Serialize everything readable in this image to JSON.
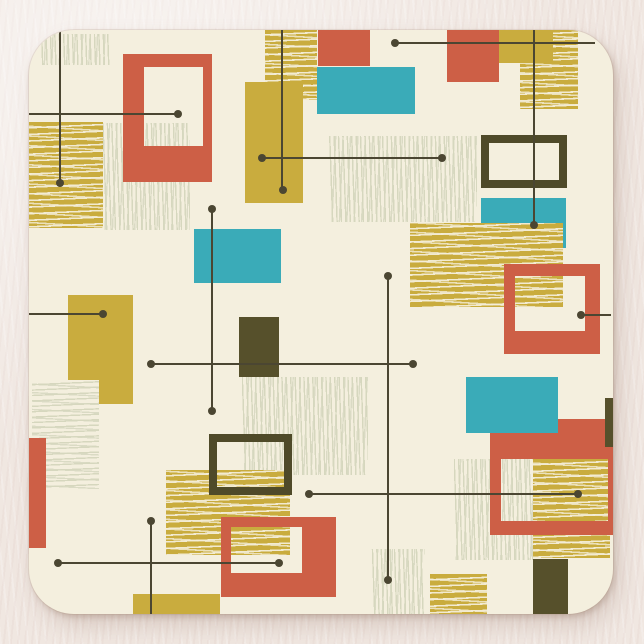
{
  "scene": {
    "description": "Square coaster product photo with mid-century modern abstract geometric pattern",
    "background_color": "#f0e7e1",
    "palette": {
      "cream": "#f4efde",
      "red": "#cd5f46",
      "teal": "#3aabb8",
      "mustard": "#c9ac3e",
      "olive": "#56502b",
      "olive_frame": "#4f4a29",
      "line": "#4b4632",
      "light_hatch_stroke": "#d6d7be",
      "mustard_hatch_stroke": "#f4eed9"
    },
    "coaster": {
      "x": 29,
      "y": 30,
      "w": 584,
      "h": 584,
      "radius": 45,
      "face_color": "#f4efde"
    },
    "shapes": [
      {
        "name": "hatch-light-topleft-corner",
        "type": "hatch",
        "hatch": "light-v",
        "x": 39,
        "y": 34,
        "w": 71,
        "h": 31
      },
      {
        "name": "hatch-mustard-left",
        "type": "hatch",
        "hatch": "mustard-h",
        "x": 29,
        "y": 122,
        "w": 74,
        "h": 106
      },
      {
        "name": "hatch-light-midleft",
        "type": "hatch",
        "hatch": "light-v",
        "x": 103,
        "y": 123,
        "w": 87,
        "h": 107
      },
      {
        "name": "frame-red-topleft",
        "type": "frame",
        "color": "red",
        "x": 123,
        "y": 54,
        "w": 89,
        "h": 128,
        "borders": {
          "t": 13,
          "r": 9,
          "b": 36,
          "l": 21
        }
      },
      {
        "name": "hatch-mustard-topcenter",
        "type": "hatch",
        "hatch": "mustard-h",
        "x": 265,
        "y": 29,
        "w": 52,
        "h": 71
      },
      {
        "name": "rect-mustard-topcenter",
        "type": "rect",
        "color": "mustard",
        "x": 245,
        "y": 82,
        "w": 58,
        "h": 121
      },
      {
        "name": "rect-red-top-a",
        "type": "rect",
        "color": "red",
        "x": 318,
        "y": 28,
        "w": 52,
        "h": 38
      },
      {
        "name": "rect-teal-top",
        "type": "rect",
        "color": "teal",
        "x": 317,
        "y": 67,
        "w": 98,
        "h": 47
      },
      {
        "name": "hatch-mustard-topright",
        "type": "hatch",
        "hatch": "mustard-h",
        "x": 520,
        "y": 29,
        "w": 58,
        "h": 80
      },
      {
        "name": "rect-mustard-topright",
        "type": "rect",
        "color": "mustard",
        "x": 499,
        "y": 29,
        "w": 54,
        "h": 34
      },
      {
        "name": "rect-red-top-b",
        "type": "rect",
        "color": "red",
        "x": 447,
        "y": 29,
        "w": 52,
        "h": 53
      },
      {
        "name": "hatch-light-rightmid",
        "type": "hatch",
        "hatch": "light-v",
        "x": 329,
        "y": 136,
        "w": 148,
        "h": 86
      },
      {
        "name": "frame-olive-right",
        "type": "frame",
        "color": "olive_frame",
        "x": 481,
        "y": 135,
        "w": 86,
        "h": 53,
        "borders": {
          "t": 8,
          "r": 8,
          "b": 8,
          "l": 8
        }
      },
      {
        "name": "rect-teal-right",
        "type": "rect",
        "color": "teal",
        "x": 481,
        "y": 198,
        "w": 85,
        "h": 50
      },
      {
        "name": "hatch-mustard-rightmid",
        "type": "hatch",
        "hatch": "mustard-h",
        "x": 410,
        "y": 223,
        "w": 153,
        "h": 84
      },
      {
        "name": "frame-red-right",
        "type": "frame",
        "color": "red",
        "x": 504,
        "y": 264,
        "w": 96,
        "h": 90,
        "borders": {
          "t": 12,
          "r": 15,
          "b": 23,
          "l": 11
        }
      },
      {
        "name": "rect-teal-midleft",
        "type": "rect",
        "color": "teal",
        "x": 194,
        "y": 229,
        "w": 87,
        "h": 54
      },
      {
        "name": "rect-olive-center",
        "type": "rect",
        "color": "olive",
        "x": 239,
        "y": 317,
        "w": 40,
        "h": 60
      },
      {
        "name": "rect-mustard-left",
        "type": "rect",
        "color": "mustard",
        "x": 68,
        "y": 295,
        "w": 65,
        "h": 109
      },
      {
        "name": "hatch-light-left",
        "type": "hatch",
        "hatch": "light-h",
        "x": 32,
        "y": 380,
        "w": 67,
        "h": 109
      },
      {
        "name": "rect-red-leftedge",
        "type": "rect",
        "color": "red",
        "x": 29,
        "y": 438,
        "w": 17,
        "h": 110
      },
      {
        "name": "hatch-light-center",
        "type": "hatch",
        "hatch": "light-v",
        "x": 242,
        "y": 377,
        "w": 126,
        "h": 98
      },
      {
        "name": "hatch-mustard-center",
        "type": "hatch",
        "hatch": "mustard-h",
        "x": 166,
        "y": 470,
        "w": 124,
        "h": 85
      },
      {
        "name": "frame-olive-center",
        "type": "frame",
        "color": "olive_frame",
        "x": 209,
        "y": 434,
        "w": 83,
        "h": 61,
        "borders": {
          "t": 8,
          "r": 8,
          "b": 8,
          "l": 8
        }
      },
      {
        "name": "frame-red-bottomleft",
        "type": "frame",
        "color": "red",
        "x": 221,
        "y": 517,
        "w": 115,
        "h": 80,
        "borders": {
          "t": 10,
          "r": 34,
          "b": 24,
          "l": 10
        }
      },
      {
        "name": "hatch-light-bottomright-inner",
        "type": "hatch",
        "hatch": "light-v",
        "x": 454,
        "y": 459,
        "w": 79,
        "h": 101
      },
      {
        "name": "hatch-mustard-bottomright",
        "type": "hatch",
        "hatch": "mustard-h",
        "x": 533,
        "y": 459,
        "w": 77,
        "h": 99
      },
      {
        "name": "frame-red-bottomright",
        "type": "frame",
        "color": "red",
        "x": 490,
        "y": 419,
        "w": 123,
        "h": 116,
        "borders": {
          "t": 40,
          "r": 5,
          "b": 14,
          "l": 11
        }
      },
      {
        "name": "rect-teal-bottomright",
        "type": "rect",
        "color": "teal",
        "x": 466,
        "y": 377,
        "w": 92,
        "h": 56
      },
      {
        "name": "rect-olive-rightedge",
        "type": "rect",
        "color": "olive",
        "x": 605,
        "y": 398,
        "w": 9,
        "h": 49
      },
      {
        "name": "hatch-light-bottom",
        "type": "hatch",
        "hatch": "light-v",
        "x": 371,
        "y": 549,
        "w": 54,
        "h": 65
      },
      {
        "name": "hatch-mustard-bottom",
        "type": "hatch",
        "hatch": "mustard-h",
        "x": 430,
        "y": 574,
        "w": 57,
        "h": 40
      },
      {
        "name": "rect-olive-bottom",
        "type": "rect",
        "color": "olive",
        "x": 533,
        "y": 559,
        "w": 35,
        "h": 55
      },
      {
        "name": "rect-mustard-bottomleft",
        "type": "rect",
        "color": "mustard",
        "x": 133,
        "y": 594,
        "w": 87,
        "h": 20
      }
    ],
    "lines": [
      {
        "name": "line-v-topleft",
        "x1": 60,
        "y1": 31,
        "x2": 60,
        "y2": 183
      },
      {
        "name": "line-h-topleft",
        "x1": 29,
        "y1": 114,
        "x2": 178,
        "y2": 114
      },
      {
        "name": "line-v-topcenter",
        "x1": 282,
        "y1": 29,
        "x2": 282,
        "y2": 190
      },
      {
        "name": "line-h-midtop",
        "x1": 262,
        "y1": 158,
        "x2": 442,
        "y2": 158
      },
      {
        "name": "line-h-topright",
        "x1": 395,
        "y1": 43,
        "x2": 595,
        "y2": 43
      },
      {
        "name": "line-v-topright",
        "x1": 534,
        "y1": 29,
        "x2": 534,
        "y2": 225
      },
      {
        "name": "line-v-center",
        "x1": 212,
        "y1": 209,
        "x2": 212,
        "y2": 411
      },
      {
        "name": "line-h-left",
        "x1": 29,
        "y1": 314,
        "x2": 103,
        "y2": 314
      },
      {
        "name": "line-h-center",
        "x1": 151,
        "y1": 364,
        "x2": 413,
        "y2": 364
      },
      {
        "name": "line-v-centerright",
        "x1": 388,
        "y1": 276,
        "x2": 388,
        "y2": 580
      },
      {
        "name": "line-h-lowermid",
        "x1": 309,
        "y1": 494,
        "x2": 578,
        "y2": 494
      },
      {
        "name": "line-h-bottomleft",
        "x1": 58,
        "y1": 563,
        "x2": 279,
        "y2": 563
      },
      {
        "name": "line-v-bottomleft",
        "x1": 151,
        "y1": 521,
        "x2": 151,
        "y2": 614
      },
      {
        "name": "line-h-rightedge",
        "x1": 581,
        "y1": 315,
        "x2": 611,
        "y2": 315
      }
    ],
    "dots": [
      {
        "x": 60,
        "y": 183
      },
      {
        "x": 178,
        "y": 114
      },
      {
        "x": 283,
        "y": 190
      },
      {
        "x": 262,
        "y": 158
      },
      {
        "x": 442,
        "y": 158
      },
      {
        "x": 395,
        "y": 43
      },
      {
        "x": 534,
        "y": 225
      },
      {
        "x": 212,
        "y": 209
      },
      {
        "x": 212,
        "y": 411
      },
      {
        "x": 103,
        "y": 314
      },
      {
        "x": 151,
        "y": 364
      },
      {
        "x": 413,
        "y": 364
      },
      {
        "x": 388,
        "y": 276
      },
      {
        "x": 388,
        "y": 580
      },
      {
        "x": 309,
        "y": 494
      },
      {
        "x": 578,
        "y": 494
      },
      {
        "x": 58,
        "y": 563
      },
      {
        "x": 279,
        "y": 563
      },
      {
        "x": 151,
        "y": 521
      },
      {
        "x": 581,
        "y": 315
      }
    ],
    "line_thickness": 2,
    "dot_diameter": 8
  }
}
